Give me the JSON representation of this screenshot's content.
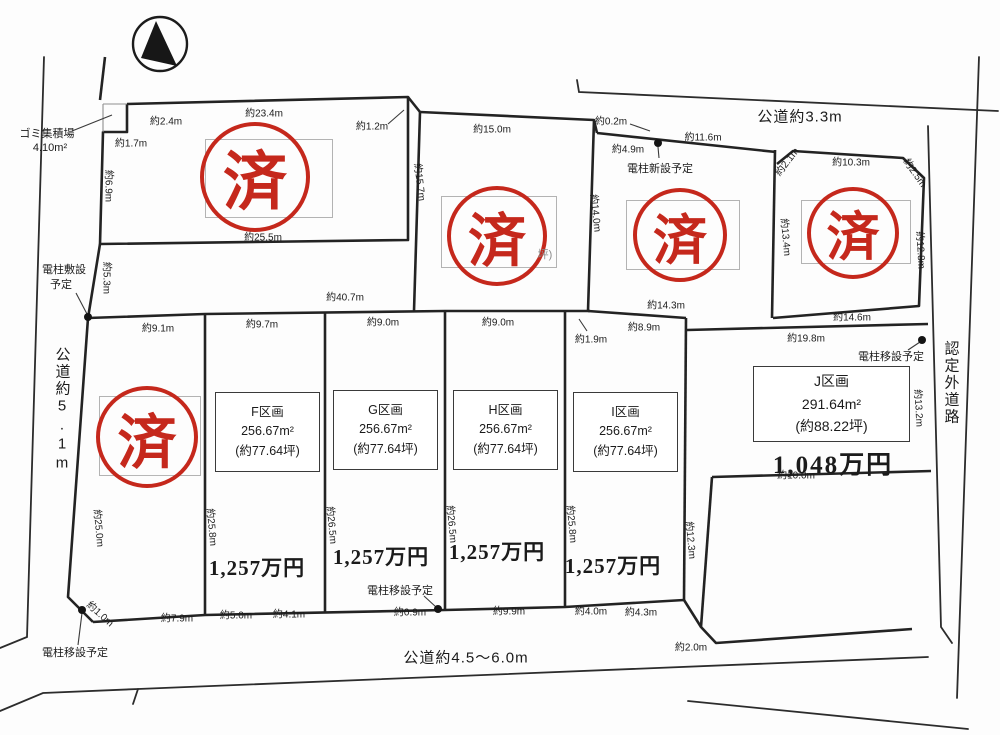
{
  "drawing_type": "land-subdivision-plot-map",
  "colors": {
    "stamp_red": "#c5281c",
    "line": "#232323",
    "background": "#fdfdfd"
  },
  "stamp_char": "済",
  "roads": {
    "top": "公道約3.3m",
    "bottom": "公道約4.5〜6.0m",
    "left": "公道約5.1m",
    "right": "認定外道路"
  },
  "plot_boxes": [
    {
      "x": 215,
      "y": 392,
      "w": 103,
      "h": 78,
      "big": false,
      "lines": [
        "F区画",
        "256.67m²",
        "(約77.64坪)"
      ]
    },
    {
      "x": 333,
      "y": 390,
      "w": 103,
      "h": 78,
      "big": false,
      "lines": [
        "G区画",
        "256.67m²",
        "(約77.64坪)"
      ]
    },
    {
      "x": 453,
      "y": 390,
      "w": 103,
      "h": 78,
      "big": false,
      "lines": [
        "H区画",
        "256.67m²",
        "(約77.64坪)"
      ]
    },
    {
      "x": 573,
      "y": 392,
      "w": 103,
      "h": 78,
      "big": false,
      "lines": [
        "I区画",
        "256.67m²",
        "(約77.64坪)"
      ]
    },
    {
      "x": 753,
      "y": 366,
      "w": 155,
      "h": 74,
      "big": true,
      "lines": [
        "J区画",
        "291.64m²",
        "(約88.22坪)"
      ]
    }
  ],
  "stamps": [
    {
      "cx": 255,
      "cy": 177,
      "r": 51
    },
    {
      "cx": 497,
      "cy": 236,
      "r": 46
    },
    {
      "cx": 680,
      "cy": 235,
      "r": 43
    },
    {
      "cx": 853,
      "cy": 233,
      "r": 42
    },
    {
      "cx": 147,
      "cy": 437,
      "r": 47
    }
  ],
  "ghost_boxes": [
    {
      "x": 205,
      "y": 139,
      "w": 126,
      "h": 77
    },
    {
      "x": 441,
      "y": 196,
      "w": 114,
      "h": 70
    },
    {
      "x": 626,
      "y": 200,
      "w": 112,
      "h": 68
    },
    {
      "x": 801,
      "y": 200,
      "w": 108,
      "h": 62
    },
    {
      "x": 99,
      "y": 396,
      "w": 100,
      "h": 78
    }
  ],
  "poles": [
    {
      "x": 658,
      "y": 143
    },
    {
      "x": 88,
      "y": 317
    },
    {
      "x": 82,
      "y": 610
    },
    {
      "x": 438,
      "y": 609
    },
    {
      "x": 922,
      "y": 340
    }
  ],
  "labels": [
    {
      "n": "road-label-top",
      "c": "road",
      "t": "公道約3.3m",
      "x": 800,
      "y": 116,
      "r": 0
    },
    {
      "n": "road-label-bottom",
      "c": "road",
      "t": "公道約4.5〜6.0m",
      "x": 466,
      "y": 657,
      "r": 0
    },
    {
      "n": "road-label-left",
      "c": "vroad",
      "t": "公道約5.1m",
      "x": 62,
      "y": 410,
      "r": 0
    },
    {
      "n": "road-label-right",
      "c": "vroad",
      "t": "認定外道路",
      "x": 951,
      "y": 383,
      "r": 0
    },
    {
      "n": "note-garbage-station",
      "c": "note",
      "t": "ゴミ集積場",
      "x": 47,
      "y": 133,
      "r": 0
    },
    {
      "n": "note-garbage-area",
      "c": "note",
      "t": "4.10m²",
      "x": 50,
      "y": 148,
      "r": 0
    },
    {
      "n": "note-pole-plan-left-1",
      "c": "note",
      "t": "電柱敷設",
      "x": 64,
      "y": 269,
      "r": 0
    },
    {
      "n": "note-pole-plan-left-2",
      "c": "note",
      "t": "予定",
      "x": 61,
      "y": 284,
      "r": 0
    },
    {
      "n": "note-pole-new-top",
      "c": "note",
      "t": "電柱新設予定",
      "x": 660,
      "y": 168,
      "r": 0
    },
    {
      "n": "note-pole-move-right",
      "c": "note",
      "t": "電柱移設予定",
      "x": 891,
      "y": 356,
      "r": 0
    },
    {
      "n": "note-pole-move-bottom",
      "c": "note",
      "t": "電柱移設予定",
      "x": 400,
      "y": 590,
      "r": 0
    },
    {
      "n": "note-pole-move-left",
      "c": "note",
      "t": "電柱移設予定",
      "x": 75,
      "y": 652,
      "r": 0
    },
    {
      "n": "covered-text-fragment",
      "c": "frag",
      "t": "坪)",
      "x": 545,
      "y": 254,
      "r": 0
    },
    {
      "n": "price-f",
      "c": "price",
      "t": "1,257万円",
      "x": 257,
      "y": 567,
      "r": 0
    },
    {
      "n": "price-g",
      "c": "price",
      "t": "1,257万円",
      "x": 381,
      "y": 556,
      "r": 0
    },
    {
      "n": "price-h",
      "c": "price",
      "t": "1,257万円",
      "x": 497,
      "y": 551,
      "r": 0
    },
    {
      "n": "price-i",
      "c": "price",
      "t": "1,257万円",
      "x": 613,
      "y": 565,
      "r": 0
    },
    {
      "n": "price-j",
      "c": "price-lg",
      "t": "1,048万円",
      "x": 833,
      "y": 463,
      "r": 0
    },
    {
      "n": "dim",
      "c": "dim",
      "t": "約23.4m",
      "x": 264,
      "y": 112,
      "r": 0
    },
    {
      "n": "dim",
      "c": "dim",
      "t": "約2.4m",
      "x": 166,
      "y": 120,
      "r": 0
    },
    {
      "n": "dim",
      "c": "dim",
      "t": "約1.7m",
      "x": 131,
      "y": 142,
      "r": 0
    },
    {
      "n": "dim",
      "c": "dim",
      "t": "約1.2m",
      "x": 372,
      "y": 125,
      "r": 0
    },
    {
      "n": "dim",
      "c": "dim",
      "t": "約25.5m",
      "x": 263,
      "y": 236,
      "r": 0
    },
    {
      "n": "dim",
      "c": "dim",
      "t": "約6.9m",
      "x": 110,
      "y": 186,
      "r": 90
    },
    {
      "n": "dim",
      "c": "dim",
      "t": "約5.3m",
      "x": 108,
      "y": 278,
      "r": 90
    },
    {
      "n": "dim",
      "c": "dim",
      "t": "約15.0m",
      "x": 492,
      "y": 128,
      "r": 0
    },
    {
      "n": "dim",
      "c": "dim",
      "t": "約15.7m",
      "x": 421,
      "y": 182,
      "r": 83
    },
    {
      "n": "dim",
      "c": "dim",
      "t": "約14.0m",
      "x": 597,
      "y": 213,
      "r": 84
    },
    {
      "n": "dim",
      "c": "dim",
      "t": "約0.2m",
      "x": 611,
      "y": 120,
      "r": 0
    },
    {
      "n": "dim",
      "c": "dim",
      "t": "約4.9m",
      "x": 628,
      "y": 148,
      "r": 0
    },
    {
      "n": "dim",
      "c": "dim",
      "t": "約11.6m",
      "x": 703,
      "y": 136,
      "r": 0
    },
    {
      "n": "dim",
      "c": "dim",
      "t": "約2.1m",
      "x": 786,
      "y": 161,
      "r": -52
    },
    {
      "n": "dim",
      "c": "dim",
      "t": "約10.3m",
      "x": 851,
      "y": 161,
      "r": 0
    },
    {
      "n": "dim",
      "c": "dim",
      "t": "約2.5m",
      "x": 916,
      "y": 172,
      "r": 55
    },
    {
      "n": "dim",
      "c": "dim",
      "t": "約13.4m",
      "x": 787,
      "y": 237,
      "r": 85
    },
    {
      "n": "dim",
      "c": "dim",
      "t": "約12.8m",
      "x": 922,
      "y": 250,
      "r": 87
    },
    {
      "n": "dim",
      "c": "dim",
      "t": "約14.6m",
      "x": 852,
      "y": 316,
      "r": 0
    },
    {
      "n": "dim",
      "c": "dim",
      "t": "約14.3m",
      "x": 666,
      "y": 304,
      "r": 0
    },
    {
      "n": "dim",
      "c": "dim",
      "t": "約40.7m",
      "x": 345,
      "y": 296,
      "r": 0
    },
    {
      "n": "dim",
      "c": "dim",
      "t": "約9.1m",
      "x": 158,
      "y": 327,
      "r": 0
    },
    {
      "n": "dim",
      "c": "dim",
      "t": "約9.7m",
      "x": 262,
      "y": 323,
      "r": 0
    },
    {
      "n": "dim",
      "c": "dim",
      "t": "約9.0m",
      "x": 383,
      "y": 321,
      "r": 0
    },
    {
      "n": "dim",
      "c": "dim",
      "t": "約9.0m",
      "x": 498,
      "y": 321,
      "r": 0
    },
    {
      "n": "dim",
      "c": "dim",
      "t": "約1.9m",
      "x": 591,
      "y": 338,
      "r": 0
    },
    {
      "n": "dim",
      "c": "dim",
      "t": "約8.9m",
      "x": 644,
      "y": 326,
      "r": 0
    },
    {
      "n": "dim",
      "c": "dim",
      "t": "約19.8m",
      "x": 806,
      "y": 337,
      "r": 0
    },
    {
      "n": "dim",
      "c": "dim",
      "t": "約10.0m",
      "x": 796,
      "y": 474,
      "r": 0
    },
    {
      "n": "dim",
      "c": "dim",
      "t": "約13.2m",
      "x": 920,
      "y": 408,
      "r": 87
    },
    {
      "n": "dim",
      "c": "dim",
      "t": "約12.3m",
      "x": 692,
      "y": 540,
      "r": 85
    },
    {
      "n": "dim",
      "c": "dim",
      "t": "約25.0m",
      "x": 100,
      "y": 528,
      "r": 85
    },
    {
      "n": "dim",
      "c": "dim",
      "t": "約25.8m",
      "x": 213,
      "y": 527,
      "r": 85
    },
    {
      "n": "dim",
      "c": "dim",
      "t": "約26.5m",
      "x": 333,
      "y": 525,
      "r": 85
    },
    {
      "n": "dim",
      "c": "dim",
      "t": "約26.5m",
      "x": 453,
      "y": 524,
      "r": 85
    },
    {
      "n": "dim",
      "c": "dim",
      "t": "約25.8m",
      "x": 573,
      "y": 524,
      "r": 85
    },
    {
      "n": "dim",
      "c": "dim",
      "t": "約7.9m",
      "x": 177,
      "y": 617,
      "r": 0
    },
    {
      "n": "dim",
      "c": "dim",
      "t": "約5.0m",
      "x": 236,
      "y": 614,
      "r": 0
    },
    {
      "n": "dim",
      "c": "dim",
      "t": "約4.1m",
      "x": 289,
      "y": 613,
      "r": 0
    },
    {
      "n": "dim",
      "c": "dim",
      "t": "約0.9m",
      "x": 410,
      "y": 611,
      "r": 0
    },
    {
      "n": "dim",
      "c": "dim",
      "t": "約9.9m",
      "x": 509,
      "y": 610,
      "r": 0
    },
    {
      "n": "dim",
      "c": "dim",
      "t": "約4.0m",
      "x": 591,
      "y": 610,
      "r": 0
    },
    {
      "n": "dim",
      "c": "dim",
      "t": "約4.3m",
      "x": 641,
      "y": 611,
      "r": 0
    },
    {
      "n": "dim",
      "c": "dim",
      "t": "約2.0m",
      "x": 691,
      "y": 646,
      "r": 0
    },
    {
      "n": "dim",
      "c": "dim",
      "t": "約1.0m",
      "x": 101,
      "y": 613,
      "r": 42
    }
  ]
}
